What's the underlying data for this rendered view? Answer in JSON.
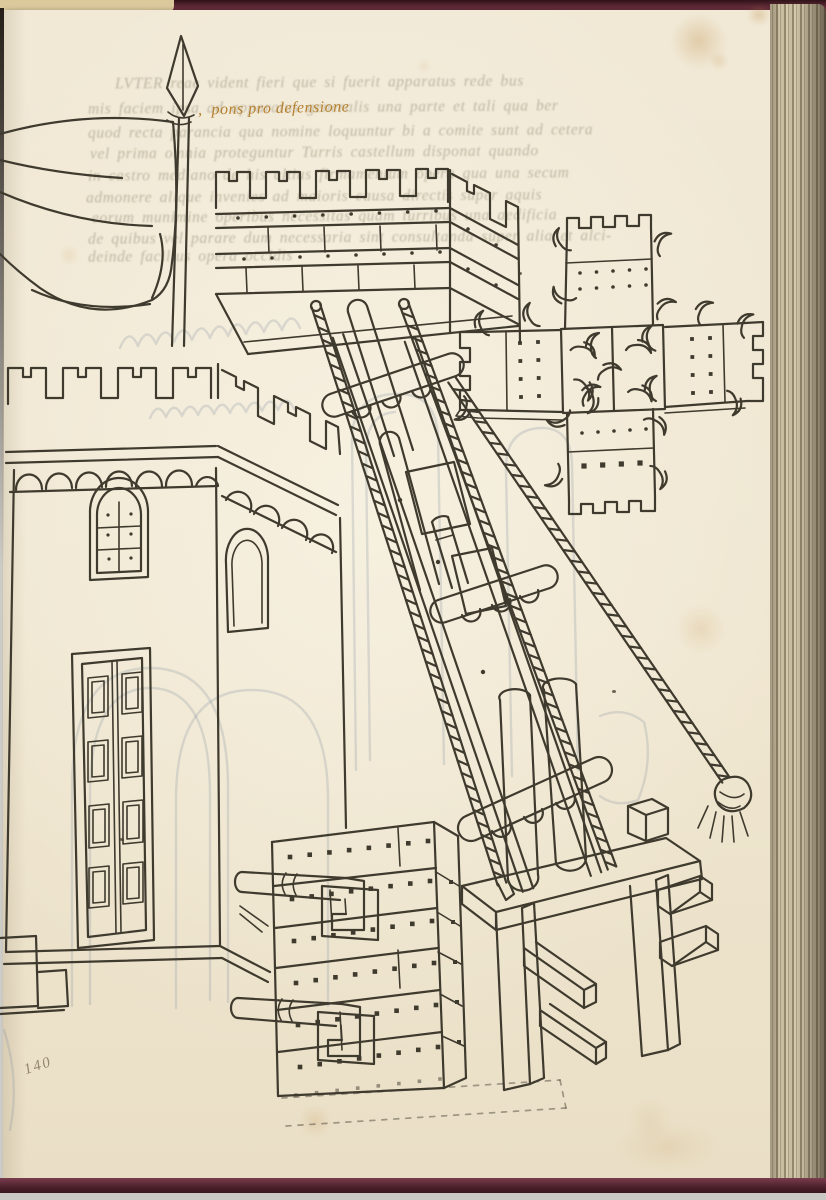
{
  "document": {
    "kind": "photograph of a manuscript folio with pen-and-ink siege-machine drawings",
    "caption": {
      "mark": ",",
      "text": "pons pro defensione"
    },
    "folio_number": "140",
    "verso_showthrough_lines": [
      "LVTER reae vident fieri que si fuerit apparatus rede bus",
      "mis faciem ipsa ad apparatus generalis una parte et tali qua ber",
      "quod recta parancia qua nomine loquuntur bi a comite sunt ad cetera",
      "vel prima omnia proteguntur Turris castellum disponat quando",
      "in castro mediano de his altius firmamentum opera qua una secum",
      "admonere alique invenies ad maioris causa directis super aquis",
      "eorum munimine operibus necessitas quam turribus una aedificia",
      "de quibus vel parare dum necessaria sint consultanda super alia et alci-",
      "deinde facilius opera occidis"
    ],
    "colors": {
      "paper": "#efe7d2",
      "ink": "#3f3a2e",
      "rubric": "#b5802f",
      "binding": "#5a2330",
      "page_edges": "#c6bb9e",
      "showthrough_text": "#9c957e",
      "showthrough_drawing": "#8793a3",
      "stain": "#bc8842"
    },
    "figures": [
      {
        "id": "banner-flag",
        "label": "banner on spear-tipped flagpole"
      },
      {
        "id": "castle-tower",
        "label": "crenellated tower with arched windows and panelled door"
      },
      {
        "id": "bridge-head",
        "label": "crenellated bridge-head platform"
      },
      {
        "id": "extension-bridge",
        "label": "inclined extension bridge with twisted ropes"
      },
      {
        "id": "bridge-plan",
        "label": "cross-shaped bridge plan with grappling hooks"
      },
      {
        "id": "studded-pier",
        "label": "nail-studded pier with two feed pipes"
      },
      {
        "id": "trestle",
        "label": "wooden trestle support stand"
      },
      {
        "id": "tassel-rope",
        "label": "guy rope ending in a tassel"
      }
    ]
  }
}
